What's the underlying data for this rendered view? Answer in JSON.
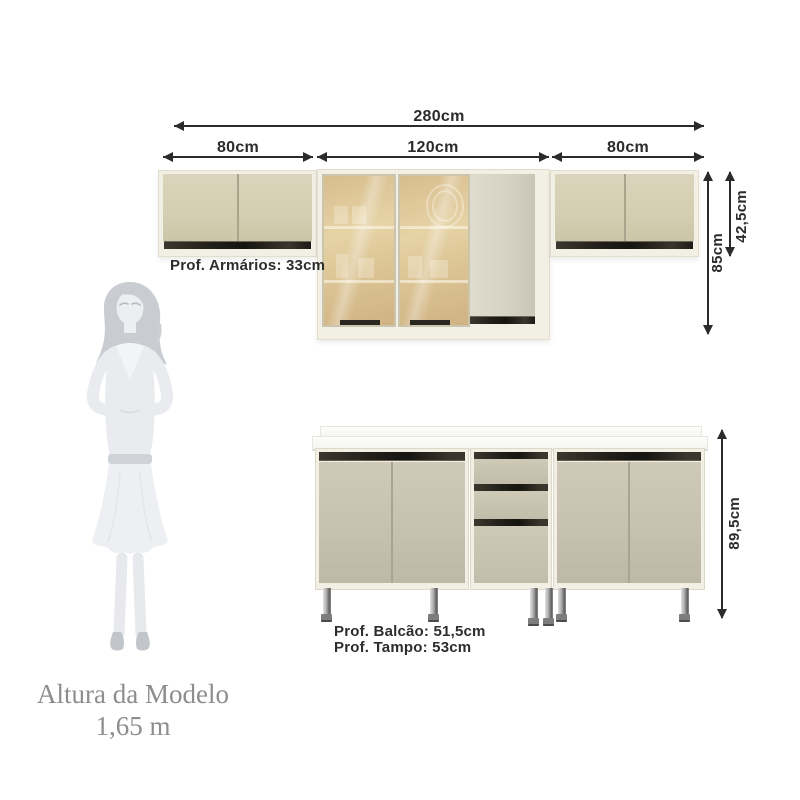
{
  "diagram": {
    "upper_row": {
      "total_width_label": "280cm",
      "segment_labels": [
        "80cm",
        "120cm",
        "80cm"
      ],
      "short_cabinet_height_label": "42,5cm",
      "tall_cabinet_height_label": "85cm",
      "depth_label": "Prof. Armários: 33cm"
    },
    "base_row": {
      "height_label": "89,5cm",
      "cabinet_depth_label": "Prof. Balcão: 51,5cm",
      "countertop_depth_label": "Prof. Tampo: 53cm"
    },
    "model_figure": {
      "caption_line1": "Altura da Modelo",
      "caption_line2": "1,65 m"
    },
    "colors": {
      "dimension_ink": "#2b2b2b",
      "upper_door": "#d4cfb2",
      "glass": "#d9be91",
      "base_door": "#c8c2b0",
      "frame": "#f2efe5",
      "handle_strip": "#23201a",
      "countertop": "#fbfbf9",
      "caption_gray": "#8d8d8d"
    }
  }
}
